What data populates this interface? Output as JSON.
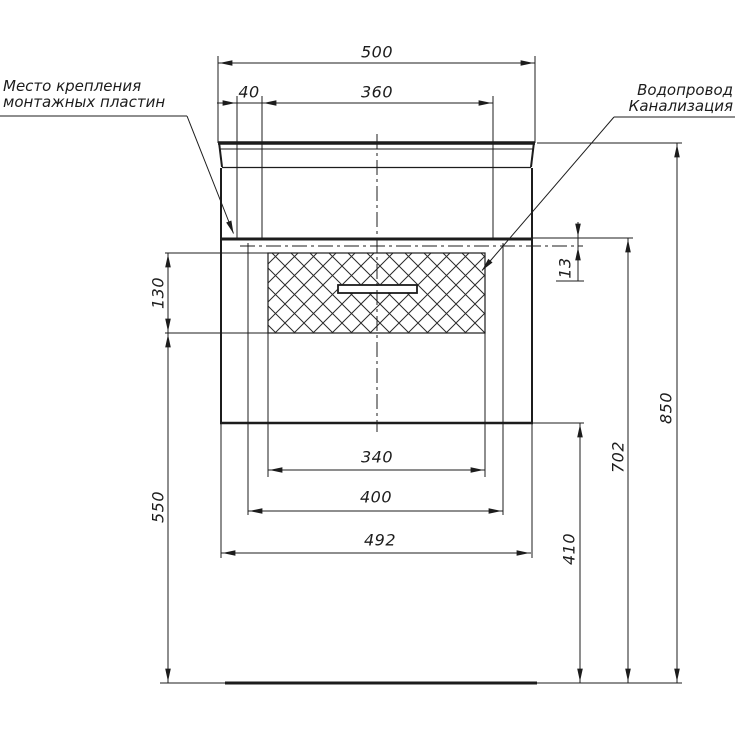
{
  "drawing": {
    "title": "wall-hung vanity unit installation scheme, front view",
    "notes": {
      "mounting_line1": "Место крепления",
      "mounting_line2": "монтажных пластин",
      "utilities_line1": "Водопровод",
      "utilities_line2": "Канализация"
    },
    "dimensions": {
      "top_width": "500",
      "mounting_plate_width": "40",
      "mounting_plate_spacing": "360",
      "plate_axis_offset": "13",
      "drawer_front_height": "130",
      "drawer_bottom_to_floor": "550",
      "drawer_width": "340",
      "inner_width": "400",
      "cabinet_width": "492",
      "floor_to_cabinet_bottom": "410",
      "floor_to_mounting_line": "702",
      "total_height": "850"
    },
    "colors": {
      "line": "#1c1c1c",
      "background": "#ffffff"
    }
  }
}
